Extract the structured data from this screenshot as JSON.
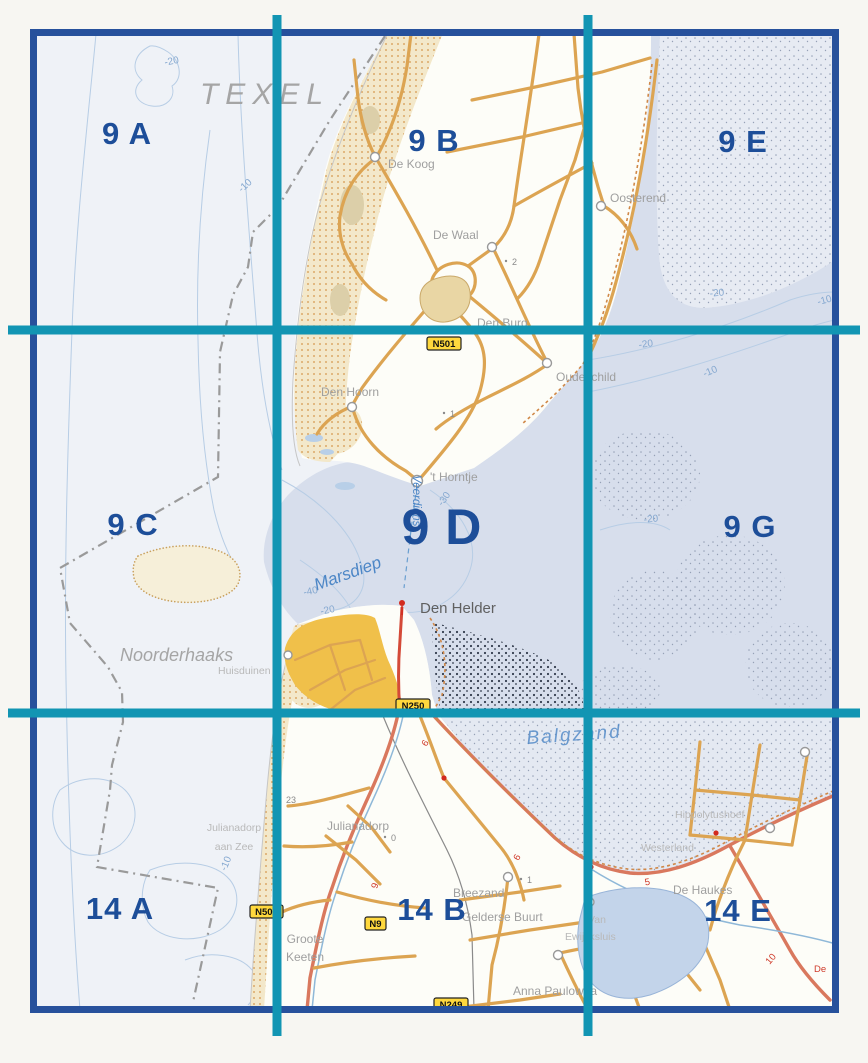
{
  "colors": {
    "grid_teal": "#1295b3",
    "frame_blue": "#27519c",
    "sheet_label_blue": "#1d4e99",
    "water_label_blue": "#4c86c6",
    "road_tan": "#dca452",
    "highway_salmon": "#d9785e",
    "urban_yellow": "#f0c04a",
    "shield_yellow": "#ffd83d",
    "dune_sand": "#f3e8ca",
    "sea_tint": "#d7deec"
  },
  "sheets": [
    {
      "id": "9A",
      "label": "9 A"
    },
    {
      "id": "9B",
      "label": "9 B"
    },
    {
      "id": "9E",
      "label": "9 E"
    },
    {
      "id": "9C",
      "label": "9 C"
    },
    {
      "id": "9D",
      "label": "9 D"
    },
    {
      "id": "9G",
      "label": "9 G"
    },
    {
      "id": "14A",
      "label": "14 A"
    },
    {
      "id": "14B",
      "label": "14 B"
    },
    {
      "id": "14E",
      "label": "14 E"
    }
  ],
  "region": {
    "texel": "TEXEL",
    "noorderhaaks": "Noorderhaaks"
  },
  "water": {
    "marsdiep": "Marsdiep",
    "balgzand": "Balgzand",
    "veerdienst": "Veerdienst"
  },
  "towns": {
    "de_koog": "De Koog",
    "de_waal": "De Waal",
    "den_burg": "Den Burg",
    "den_hoorn": "Den Hoorn",
    "oudeschild": "Oudeschild",
    "t_horntje": "'t Horntje",
    "oosterend": "Oosterend",
    "den_helder": "Den Helder",
    "huisduinen": "Huisduinen",
    "julianadorp": "Julianadorp",
    "jaz1": "Julianadorp",
    "jaz2": "aan Zee",
    "breezand": "Breezand",
    "gelderse_buurt": "Gelderse Buurt",
    "groote1": "Groote",
    "groote2": "Keeten",
    "anna_paulowna": "Anna Paulowna",
    "hippolytushoef": "Hippolytushoef",
    "westerland": "Westerland",
    "de_haukes": "De Haukes",
    "van1": "Van",
    "van2": "Ewijcksluis"
  },
  "shields": {
    "n501": "N501",
    "n250": "N250",
    "n9": "N9",
    "n502": "N502",
    "n249": "N249"
  },
  "depths": {
    "d10": "-10",
    "d20": "-20",
    "d30": "-30",
    "d40": "-40"
  },
  "km": {
    "k5": "5",
    "k6": "6",
    "k9": "9",
    "k10": "10",
    "de": "De"
  },
  "spots": {
    "s0": "0",
    "s1": "1",
    "s2": "2",
    "s23": "23"
  }
}
